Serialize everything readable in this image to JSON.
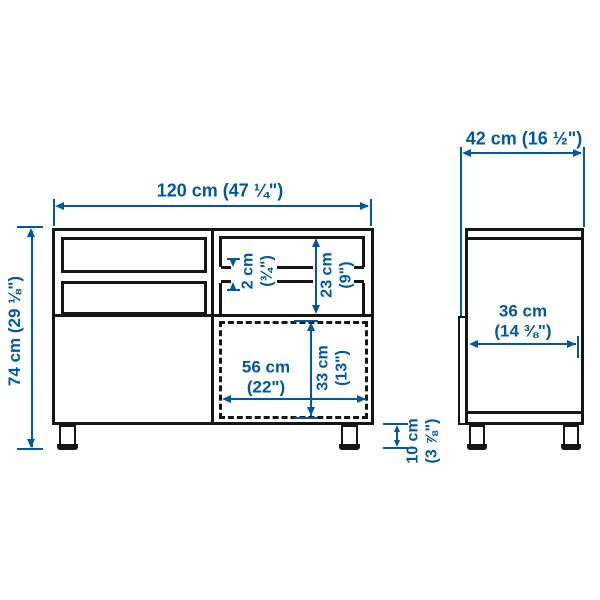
{
  "diagram_title": "TV bench dimension drawing",
  "colors": {
    "dimension_accent": "#0058a3",
    "outline": "#161616",
    "background": "#ffffff"
  },
  "front_view": {
    "total_width": "120 cm (47 ¼\")",
    "total_height": "74 cm (29 ⅛\")",
    "shelf_thickness": {
      "metric": "2 cm",
      "imperial": "(¾\")"
    },
    "open_compartment_height": {
      "metric": "23 cm",
      "imperial": "(9\")"
    },
    "drawer_space_width": {
      "metric": "56 cm",
      "imperial": "(22\")"
    },
    "drawer_space_height": {
      "metric": "33 cm",
      "imperial": "(13\")"
    },
    "leg_height": {
      "metric": "10 cm",
      "imperial": "(3 ⅞\")"
    }
  },
  "side_view": {
    "total_depth": "42 cm (16 ½\")",
    "interior_depth": {
      "metric": "36 cm",
      "imperial": "(14 ⅜\")"
    }
  }
}
